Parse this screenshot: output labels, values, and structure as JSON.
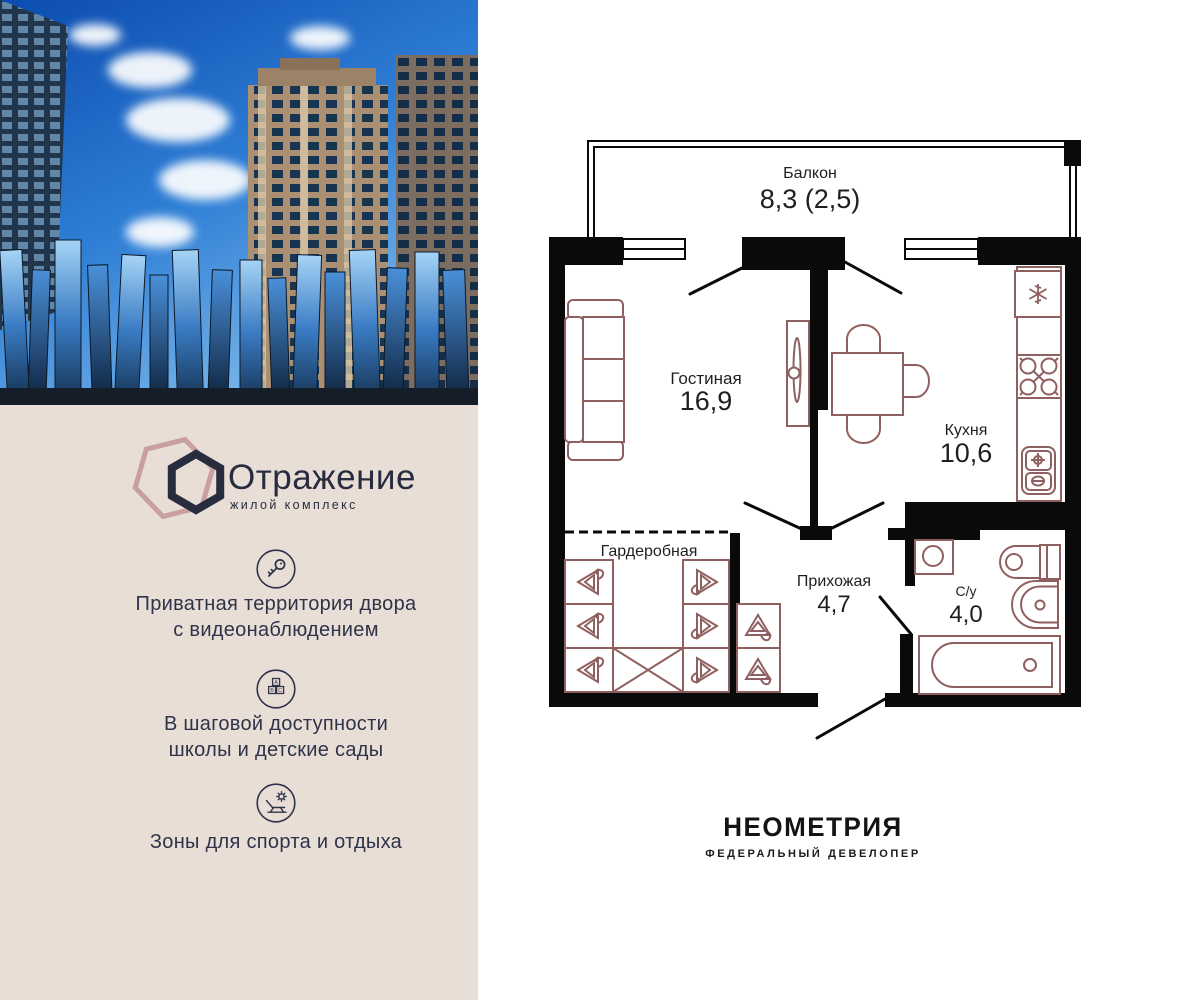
{
  "brand": {
    "logo_title": "Отражение",
    "logo_subtitle": "жилой комплекс"
  },
  "features": [
    {
      "icon": "key-icon",
      "lines": [
        "Приватная территория двора",
        "с видеонаблюдением"
      ]
    },
    {
      "icon": "abc-blocks-icon",
      "lines": [
        "В шаговой доступности",
        "школы и детские сады"
      ]
    },
    {
      "icon": "sun-lounger-icon",
      "lines": [
        "Зоны для спорта и отдыха"
      ]
    }
  ],
  "floorplan": {
    "rooms": [
      {
        "name": "Балкон",
        "area": "8,3 (2,5)"
      },
      {
        "name": "Гостиная",
        "area": "16,9"
      },
      {
        "name": "Кухня",
        "area": "10,6"
      },
      {
        "name": "Гардеробная",
        "area": ""
      },
      {
        "name": "Прихожая",
        "area": "4,7"
      },
      {
        "name": "С/у",
        "area": "4,0"
      }
    ]
  },
  "developer": {
    "name": "НЕОМЕТРИЯ",
    "tagline": "ФЕДЕРАЛЬНЫЙ ДЕВЕЛОПЕР"
  },
  "colors": {
    "panel_beige": "#e9ded6",
    "accent_navy": "#2e3349",
    "hexagon_pink": "#c8a0a0",
    "plan_walls": "#0a0a0a",
    "plan_furniture": "#8f6060",
    "developer_text": "#141414"
  }
}
